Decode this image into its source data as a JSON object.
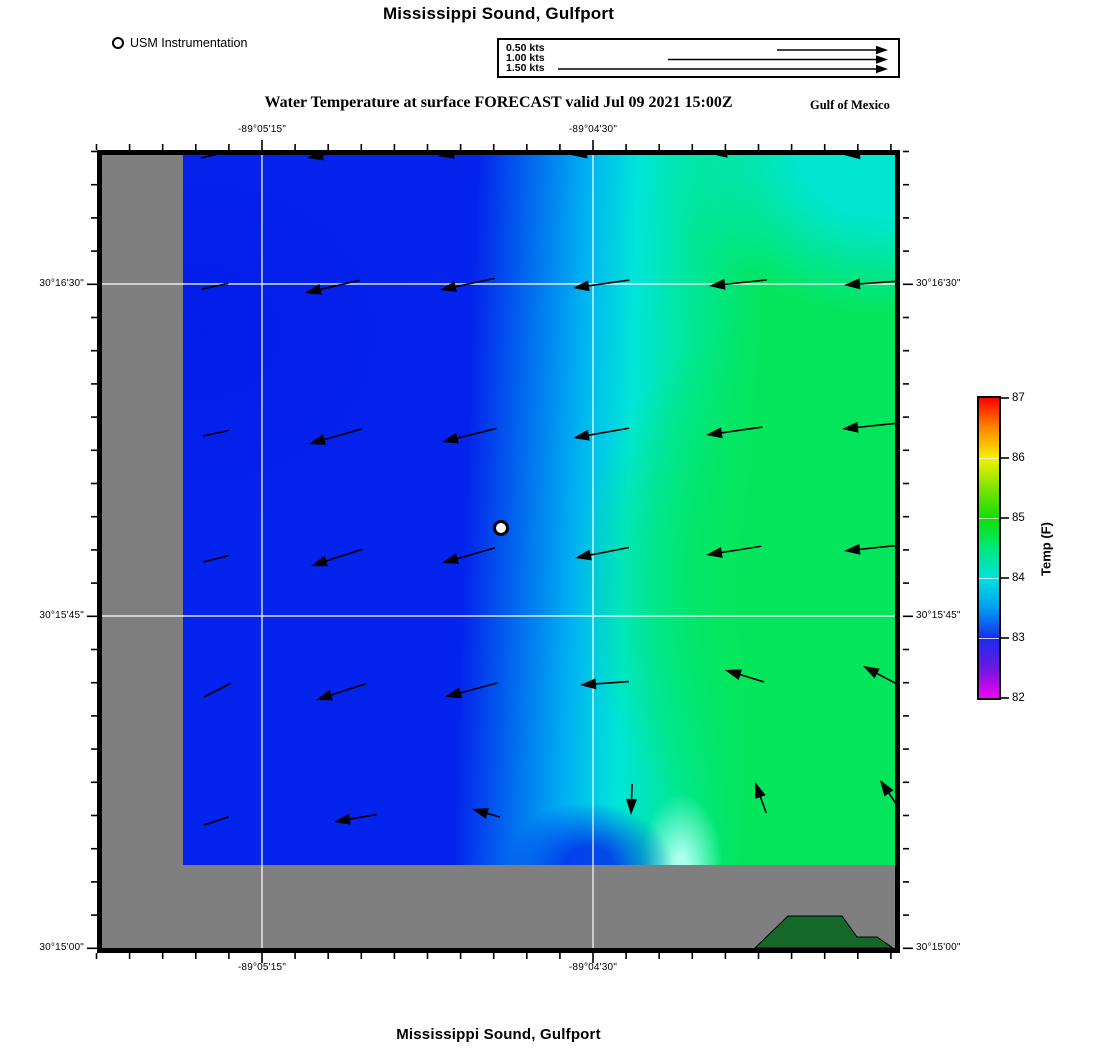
{
  "titles": {
    "top": "Mississippi Sound, Gulfport",
    "subtitle": "Water Temperature at surface FORECAST valid Jul 09 2021 15:00Z",
    "region": "Gulf of Mexico",
    "bottom": "Mississippi Sound, Gulfport"
  },
  "legend": {
    "station_label": "USM Instrumentation"
  },
  "velocity_scale": {
    "items": [
      {
        "label": "0.50 kts",
        "tail_x": 278,
        "row_y": 10
      },
      {
        "label": "1.00 kts",
        "tail_x": 169,
        "row_y": 19.5
      },
      {
        "label": "1.50 kts",
        "tail_x": 59,
        "row_y": 29
      }
    ],
    "tip_x": 389,
    "px_per_knot": 220
  },
  "axes": {
    "x_labels": [
      {
        "label": "-89°05'15\"",
        "x": 262
      },
      {
        "label": "-89°04'30\"",
        "x": 593
      }
    ],
    "y_labels": [
      {
        "label": "30°16'30\"",
        "y": 284
      },
      {
        "label": "30°15'45\"",
        "y": 616
      },
      {
        "label": "30°15'00\"",
        "y": 948
      }
    ],
    "x_minor": {
      "start": 96.5,
      "step": 33.1,
      "count": 25
    },
    "y_minor": {
      "start": 151.5,
      "step": 33.2,
      "count": 25
    }
  },
  "colorbar": {
    "title": "Temp (F)",
    "ticks": [
      87,
      86,
      85,
      84,
      83,
      82
    ],
    "min": 82,
    "max": 87,
    "stops": [
      [
        "#fa0000",
        0
      ],
      [
        "#ff8800",
        10
      ],
      [
        "#f8f000",
        20
      ],
      [
        "#7fe400",
        30
      ],
      [
        "#12df00",
        40
      ],
      [
        "#00e87c",
        50
      ],
      [
        "#00e2de",
        60
      ],
      [
        "#009ff0",
        70
      ],
      [
        "#1b2cf0",
        80
      ],
      [
        "#6b17e0",
        90
      ],
      [
        "#f203f2",
        100
      ]
    ]
  },
  "palette": {
    "water_blue": "#0423ec",
    "water_mid_blue": "#00b2f2",
    "water_cyan": "#00e6d8",
    "water_teal": "#00e795",
    "water_green": "#03e65c",
    "bright_cyan": "#aaffee",
    "deep_blue": "#0318e6",
    "mask_gray": "#7f7f7f",
    "land_green": "#15682a",
    "grid_white": "#ffffff"
  },
  "station": {
    "x": 501,
    "y": 528
  },
  "land_polygon": [
    [
      755,
      948
    ],
    [
      788,
      916
    ],
    [
      842,
      916
    ],
    [
      857,
      937
    ],
    [
      877,
      937
    ],
    [
      893,
      948
    ]
  ],
  "gridlines": {
    "x": [
      262,
      593
    ],
    "y": [
      284,
      616
    ]
  },
  "chart_data": {
    "type": "heatmap",
    "title": "Water Temperature at surface FORECAST valid Jul 09 2021 15:00Z",
    "region": "Mississippi Sound, Gulfport",
    "basin": "Gulf of Mexico",
    "variable": "Temp (F)",
    "colorbar_range": [
      82,
      87
    ],
    "colorbar_ticks": [
      87,
      86,
      85,
      84,
      83,
      82
    ],
    "x_tick_labels": [
      "-89°05'15\"",
      "-89°04'30\""
    ],
    "y_tick_labels": [
      "30°16'30\"",
      "30°15'45\"",
      "30°15'00\""
    ],
    "field_estimate_F": {
      "west": 83.2,
      "center": 83.8,
      "east": 84.8,
      "northeast": 84.2
    },
    "station": {
      "name": "USM Instrumentation",
      "x": 501,
      "y": 528
    },
    "velocity_legend_kts": [
      0.5,
      1.0,
      1.5
    ],
    "current_vectors": [
      {
        "x": 201,
        "y": 158,
        "angle": 193,
        "len": 28,
        "head": 0
      },
      {
        "x": 307,
        "y": 158,
        "angle": 191,
        "len": 55,
        "head": 1
      },
      {
        "x": 438,
        "y": 156,
        "angle": 189,
        "len": 55,
        "head": 1
      },
      {
        "x": 571,
        "y": 155,
        "angle": 187,
        "len": 57,
        "head": 1
      },
      {
        "x": 711,
        "y": 154,
        "angle": 186,
        "len": 60,
        "head": 1
      },
      {
        "x": 844,
        "y": 155,
        "angle": 184,
        "len": 60,
        "head": 1
      },
      {
        "x": 202,
        "y": 289,
        "angle": 192,
        "len": 27,
        "head": 0
      },
      {
        "x": 305,
        "y": 293,
        "angle": 193,
        "len": 56,
        "head": 1
      },
      {
        "x": 440,
        "y": 290,
        "angle": 192,
        "len": 56,
        "head": 1
      },
      {
        "x": 573,
        "y": 288,
        "angle": 188,
        "len": 57,
        "head": 1
      },
      {
        "x": 709,
        "y": 286,
        "angle": 186,
        "len": 58,
        "head": 1
      },
      {
        "x": 844,
        "y": 285,
        "angle": 184,
        "len": 60,
        "head": 1
      },
      {
        "x": 203,
        "y": 436,
        "angle": 192,
        "len": 26,
        "head": 0
      },
      {
        "x": 309,
        "y": 444,
        "angle": 196,
        "len": 55,
        "head": 1
      },
      {
        "x": 442,
        "y": 442,
        "angle": 194,
        "len": 56,
        "head": 1
      },
      {
        "x": 573,
        "y": 438,
        "angle": 190,
        "len": 57,
        "head": 1
      },
      {
        "x": 706,
        "y": 435,
        "angle": 188,
        "len": 57,
        "head": 1
      },
      {
        "x": 842,
        "y": 429,
        "angle": 186,
        "len": 58,
        "head": 1
      },
      {
        "x": 203,
        "y": 562,
        "angle": 194,
        "len": 26,
        "head": 0
      },
      {
        "x": 311,
        "y": 566,
        "angle": 198,
        "len": 54,
        "head": 1
      },
      {
        "x": 442,
        "y": 563,
        "angle": 196,
        "len": 55,
        "head": 1
      },
      {
        "x": 575,
        "y": 558,
        "angle": 191,
        "len": 55,
        "head": 1
      },
      {
        "x": 706,
        "y": 555,
        "angle": 189,
        "len": 56,
        "head": 1
      },
      {
        "x": 844,
        "y": 551,
        "angle": 186,
        "len": 58,
        "head": 1
      },
      {
        "x": 204,
        "y": 697,
        "angle": 207,
        "len": 30,
        "head": 0
      },
      {
        "x": 316,
        "y": 700,
        "angle": 198,
        "len": 53,
        "head": 1
      },
      {
        "x": 445,
        "y": 697,
        "angle": 195,
        "len": 55,
        "head": 1
      },
      {
        "x": 580,
        "y": 685,
        "angle": 184,
        "len": 49,
        "head": 1
      },
      {
        "x": 725,
        "y": 670,
        "angle": 163,
        "len": 41,
        "head": 1
      },
      {
        "x": 863,
        "y": 666,
        "angle": 152,
        "len": 42,
        "head": 1
      },
      {
        "x": 204,
        "y": 825,
        "angle": 198,
        "len": 26,
        "head": 0
      },
      {
        "x": 334,
        "y": 822,
        "angle": 190,
        "len": 43,
        "head": 1
      },
      {
        "x": 472,
        "y": 809,
        "angle": 164,
        "len": 29,
        "head": 1
      },
      {
        "x": 631,
        "y": 815,
        "angle": 268,
        "len": 31,
        "head": 1
      },
      {
        "x": 755,
        "y": 782,
        "angle": 110,
        "len": 33,
        "head": 1
      },
      {
        "x": 880,
        "y": 780,
        "angle": 124,
        "len": 31,
        "head": 1
      }
    ]
  }
}
